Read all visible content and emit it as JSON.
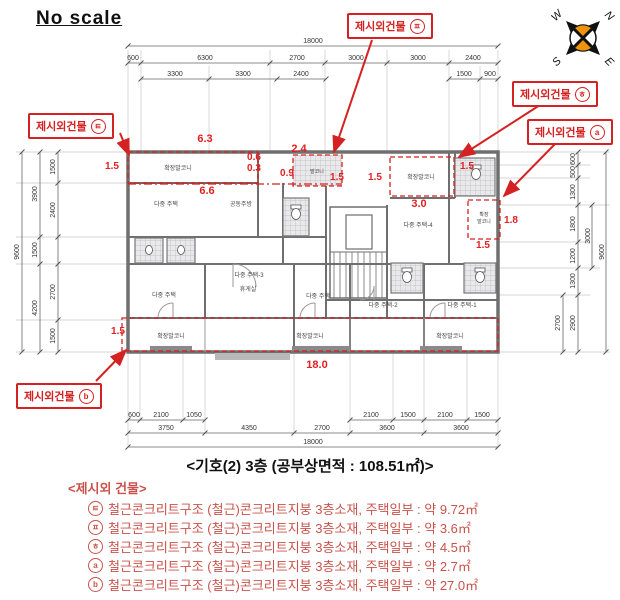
{
  "no_scale": "No scale",
  "title": "<기호(2) 3층 (공부상면적 : 108.51㎡)>",
  "colors": {
    "annotation_red": "#d42222",
    "legend_red": "#c9534b",
    "dim_red": "#e02020",
    "compass_orange": "#ef930c"
  },
  "compass": {
    "w": "W",
    "n": "N",
    "s": "S",
    "e": "E"
  },
  "callouts": {
    "top": {
      "label": "제시외건물",
      "symbol": "ㅍ"
    },
    "left": {
      "label": "제시외건물",
      "symbol": "ㅌ"
    },
    "right_upper": {
      "label": "제시외건물",
      "symbol": "ㅎ"
    },
    "right_lower": {
      "label": "제시외건물",
      "symbol": "a"
    },
    "bottom": {
      "label": "제시외건물",
      "symbol": "b"
    }
  },
  "dims_top": {
    "overall": "18000",
    "segs": [
      "600",
      "6300",
      "2700",
      "3000",
      "3000",
      "2400"
    ],
    "subs": [
      "3300",
      "3300",
      "2400",
      "1500",
      "900"
    ]
  },
  "dims_bottom": {
    "overall": "18000",
    "segs": [
      "3750",
      "4350",
      "2700",
      "3600",
      "3600"
    ],
    "subs": [
      "600",
      "2100",
      "1050",
      "2100",
      "1500",
      "2100",
      "1500"
    ]
  },
  "dims_left": {
    "overall": "9600",
    "mid": [
      "3900",
      "1500",
      "4200"
    ],
    "inner": [
      "1500",
      "2400",
      "2700",
      "1500"
    ]
  },
  "dims_right": {
    "overall": "9600",
    "inner": [
      "600",
      "500",
      "1300",
      "1800",
      "1200",
      "1300",
      "2900"
    ],
    "mid": [
      "3000",
      "2700"
    ]
  },
  "red_dims": [
    "1.5",
    "6.3",
    "6.6",
    "0.6",
    "0.3",
    "2.4",
    "0.9",
    "1.5",
    "1.5",
    "1.5",
    "3.0",
    "1.8",
    "1.5",
    "1.5",
    "18.0"
  ],
  "rooms": [
    "확장발코니",
    "다중 주택",
    "공동주방",
    "발코니",
    "확장발코니",
    "확장",
    "발코니",
    "다중 주택-4",
    "다중 주택-3",
    "휴게실",
    "다중 주택",
    "다중 주택",
    "다중 주택-2",
    "다중 주택-1",
    "확장발코니",
    "확장발코니",
    "확장발코니"
  ],
  "legend": {
    "heading": "<제시외 건물>",
    "items": [
      {
        "symbol": "ㅌ",
        "text": "철근콘크리트구조 (철근)콘크리트지붕 3층소재, 주택일부 : 약 9.72㎡"
      },
      {
        "symbol": "ㅍ",
        "text": "철근콘크리트구조 (철근)콘크리트지붕 3층소재, 주택일부 : 약 3.6㎡"
      },
      {
        "symbol": "ㅎ",
        "text": "철근콘크리트구조 (철근)콘크리트지붕 3층소재, 주택일부 : 약 4.5㎡"
      },
      {
        "symbol": "a",
        "text": "철근콘크리트구조 (철근)콘크리트지붕 3층소재, 주택일부 : 약 2.7㎡"
      },
      {
        "symbol": "b",
        "text": "철근콘크리트구조 (철근)콘크리트지붕 3층소재, 주택일부 : 약 27.0㎡"
      }
    ]
  }
}
